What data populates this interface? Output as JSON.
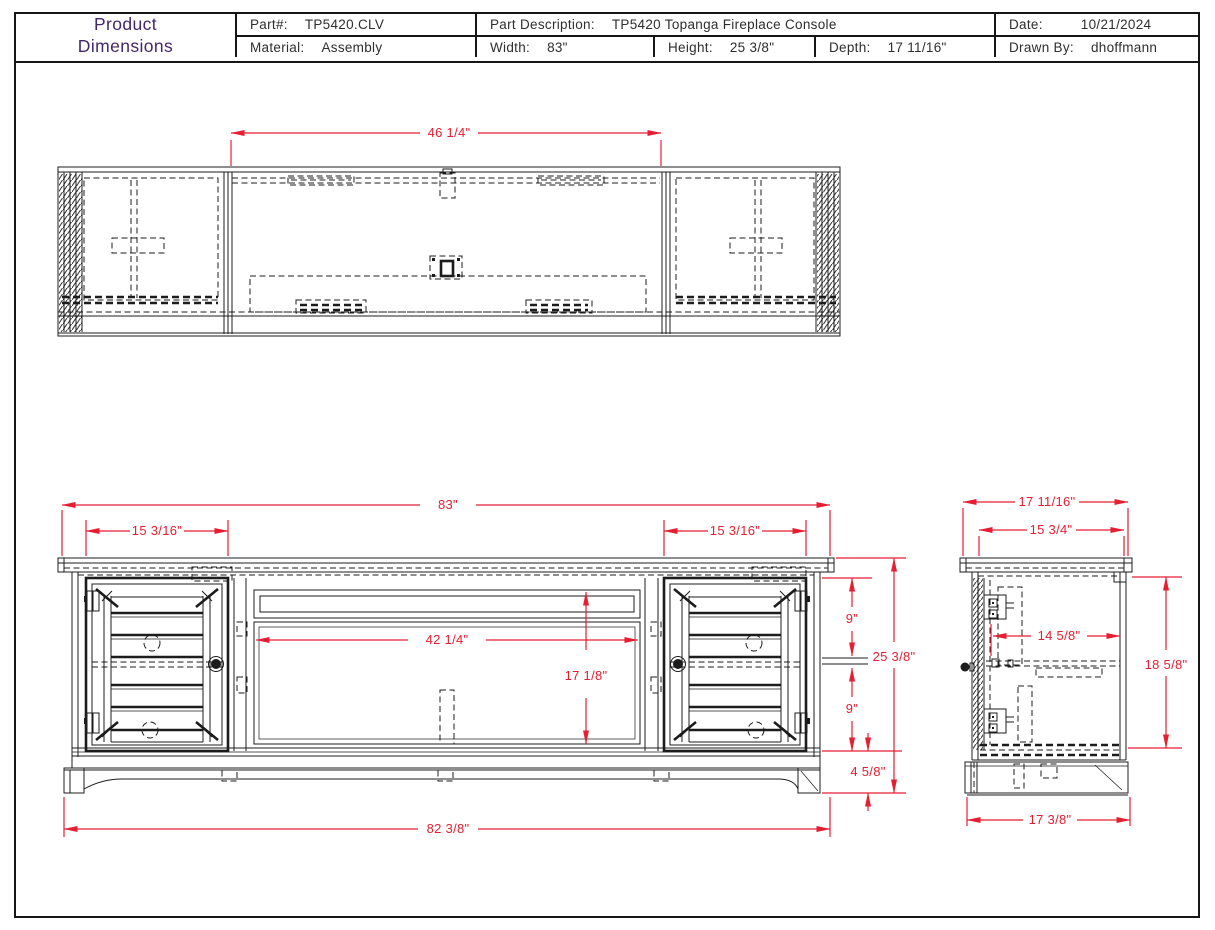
{
  "title_block": {
    "title_line1": "Product",
    "title_line2": "Dimensions",
    "part": {
      "label": "Part#:",
      "value": "TP5420.CLV"
    },
    "material": {
      "label": "Material:",
      "value": "Assembly"
    },
    "description": {
      "label": "Part Description:",
      "value": "TP5420 Topanga Fireplace Console"
    },
    "width": {
      "label": "Width:",
      "value": "83\""
    },
    "height": {
      "label": "Height:",
      "value": "25 3/8\""
    },
    "depth": {
      "label": "Depth:",
      "value": "17 11/16\""
    },
    "date": {
      "label": "Date:",
      "value": "10/21/2024"
    },
    "drawn_by": {
      "label": "Drawn By:",
      "value": "dhoffmann"
    }
  },
  "colors": {
    "dimension_red": "#e61e32",
    "line_black": "#1c1c1c",
    "title_purple": "#46266b"
  },
  "dims": {
    "top": {
      "opening_width": "46 1/4\""
    },
    "front": {
      "overall_width": "83\"",
      "left_door_width": "15 3/16\"",
      "right_door_width": "15 3/16\"",
      "opening_width": "42 1/4\"",
      "opening_height": "17 1/8\"",
      "upper_section": "9\"",
      "lower_section": "9\"",
      "overall_height": "25 3/8\"",
      "base_height": "4 5/8\"",
      "body_width": "82 3/8\""
    },
    "side": {
      "overall_depth": "17 11/16\"",
      "top_depth": "15 3/4\"",
      "interior_depth": "14 5/8\"",
      "case_height": "18 5/8\"",
      "base_depth": "17 3/8\""
    }
  }
}
